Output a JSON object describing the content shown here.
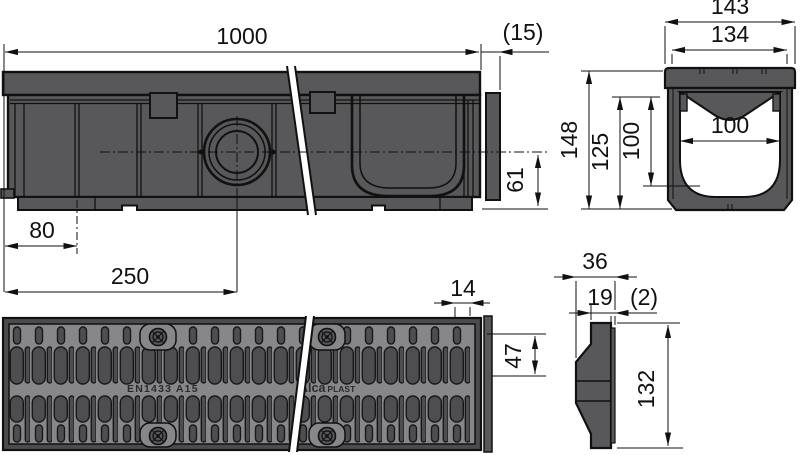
{
  "drawing_title": "Drainage channel technical drawing",
  "colors": {
    "outline": "#111111",
    "body_fill": "#58585a",
    "grate_frame": "#4b4b4d",
    "grate_field": "#87878a",
    "slot_fill": "#4e4e50",
    "background": "#ffffff"
  },
  "views": {
    "side": {
      "name": "side elevation",
      "dim_length": "1000",
      "dim_end_lip": "(15)",
      "dim_outlet_height": "61",
      "dim_outlet_offset": "80",
      "dim_outlet_center": "250"
    },
    "section": {
      "name": "cross section",
      "dim_outer_width": "143",
      "dim_top_inner_width": "134",
      "dim_channel_width": "100",
      "dim_total_height": "148",
      "dim_body_height": "125",
      "dim_inner_depth": "100"
    },
    "plan": {
      "name": "grate plan view",
      "dim_slot_pitch": "14",
      "dim_edge_height": "47",
      "mark_standard": "EN1433 A15",
      "brand_first": "Alca",
      "brand_second": "PLAST"
    },
    "endcap": {
      "name": "end cap profile",
      "dim_depth": "36",
      "dim_body_depth": "19",
      "dim_lip": "(2)",
      "dim_height": "132"
    }
  }
}
